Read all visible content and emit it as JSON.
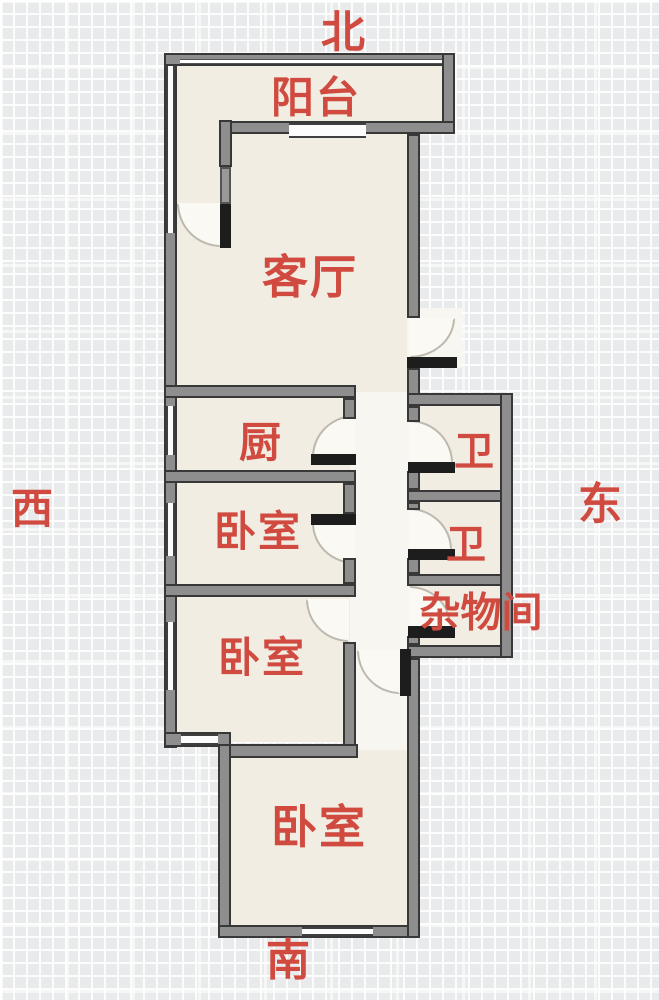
{
  "title": "apartment-floor-plan",
  "compass": {
    "north": "北",
    "south": "南",
    "east": "东",
    "west": "西"
  },
  "rooms": {
    "balcony": "阳台",
    "living_room": "客厅",
    "kitchen": "厨",
    "bedroom_1": "卧室",
    "bedroom_2": "卧室",
    "bedroom_3": "卧室",
    "bathroom_1": "卫",
    "bathroom_2": "卫",
    "storage_room": "杂物间"
  },
  "colors": {
    "label_red": "#d04a40",
    "wall_gray": "#8e8e8e",
    "wall_outline": "#383838",
    "room_fill": "#f1ede3",
    "corridor_fill": "#f8f6f0",
    "door_dark": "#1d1d1d",
    "background": "#e9eaeb"
  }
}
